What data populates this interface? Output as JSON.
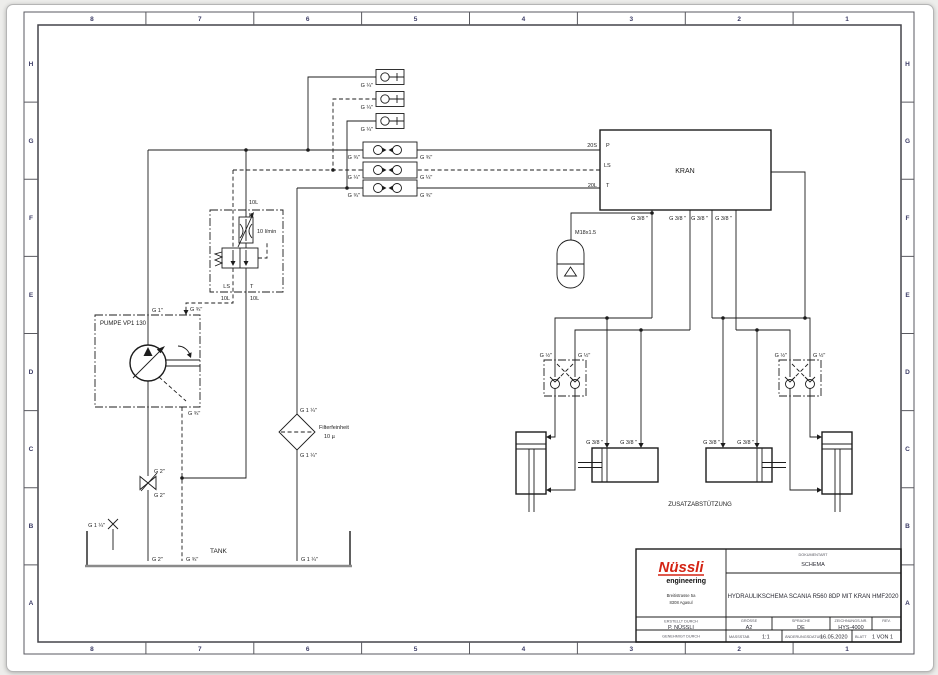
{
  "frame": {
    "columns": [
      "8",
      "7",
      "6",
      "5",
      "4",
      "3",
      "2",
      "1"
    ],
    "rows": [
      "H",
      "G",
      "F",
      "E",
      "D",
      "C",
      "B",
      "A"
    ]
  },
  "schematic": {
    "kran": {
      "name": "KRAN",
      "port_p": "P",
      "port_ls": "LS",
      "port_t": "T",
      "line_p": "20S",
      "line_t": "20L",
      "bottom_ports": [
        "G 3/8 \"",
        "G 3/8 \"",
        "G 3/8 \"",
        "G 3/8 \""
      ]
    },
    "pump": {
      "name": "PUMPE VP1 130",
      "port_pressure": "G 1\"",
      "port_ls": "G ¾\"",
      "port_drain": "G ¾\""
    },
    "valve_block": {
      "line_top": "10L",
      "port_p": "P",
      "flow_rate": "10 l/min",
      "port_ls": "LS",
      "port_t": "T",
      "line_ls": "10L",
      "line_t": "10L"
    },
    "test_points": [
      "G ¼\"",
      "G ¼\"",
      "G ¼\""
    ],
    "couplings": [
      {
        "left": "G ¾\"",
        "right": "G ¾\""
      },
      {
        "left": "G ¼\"",
        "right": "G ¼\""
      },
      {
        "left": "G ¾\"",
        "right": "G ¾\""
      }
    ],
    "accumulator": {
      "thread": "M18x1.5"
    },
    "filter": {
      "port_top": "G 1 ¼\"",
      "port_bottom": "G 1 ¼\"",
      "spec_line1": "Filterfeinheit",
      "spec_line2": "10 µ"
    },
    "ball_valve": {
      "top": "G 2\"",
      "bottom": "G 2\""
    },
    "tank": {
      "name": "TANK",
      "spare_port": "G 1 ¼\"",
      "suction_port": "G 2\"",
      "drain_port": "G ¾\"",
      "return_port": "G 1 ¼\""
    },
    "outriggers": {
      "caption": "ZUSATZABSTÜTZUNG",
      "left_check": {
        "left": "G ½\"",
        "right": "G ½\""
      },
      "right_check": {
        "left": "G ½\"",
        "right": "G ½\""
      },
      "left_cyl_ports": [
        "G 3/8 \"",
        "G 3/8 \""
      ],
      "right_cyl_ports": [
        "G 3/8 \"",
        "G 3/8 \""
      ]
    }
  },
  "titleblock": {
    "logo_main": "Nüssli",
    "logo_sub": "engineering",
    "address_line1": "Breitistrasse 5a",
    "address_line2": "8308 Agasul",
    "doc_type_label": "DOKUMENTART",
    "doc_type": "SCHEMA",
    "title": "HYDRAULIKSCHEMA SCANIA R560 8DP MIT KRAN HMF2020",
    "created_label": "ERSTELLT DURCH",
    "created_by": "P. NÜSSLI",
    "approved_label": "GENEHMIGT DURCH",
    "size_label": "GRÖSSE",
    "size": "A2",
    "lang_label": "SPRACHE",
    "lang": "DE",
    "drawing_no_label": "ZEICHNUNGS-NR.",
    "drawing_no": "HYS-4000",
    "rev_label": "REV.",
    "scale_label": "MASSSTAB",
    "scale": "1:1",
    "change_date_label": "ÄNDERUNGSDATUM",
    "change_date": "16.05.2020",
    "sheet_label": "BLATT",
    "sheet": "1 VON 1"
  }
}
